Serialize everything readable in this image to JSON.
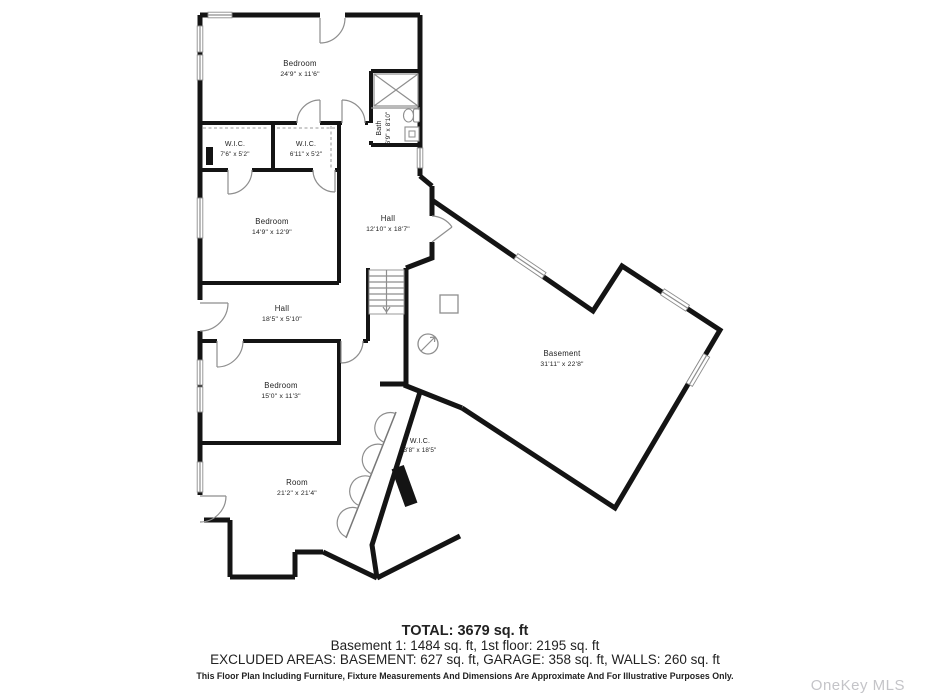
{
  "rooms": [
    {
      "name": "Bedroom",
      "dims": "24'9\" x 11'6\""
    },
    {
      "name": "W.I.C.",
      "dims": "7'6\" x 5'2\""
    },
    {
      "name": "W.I.C.",
      "dims": "6'11\" x 5'2\""
    },
    {
      "name": "Bath",
      "dims": "6'9\" x 8'10\""
    },
    {
      "name": "Bedroom",
      "dims": "14'9\" x 12'9\""
    },
    {
      "name": "Hall",
      "dims": "12'10\" x 18'7\""
    },
    {
      "name": "Hall",
      "dims": "18'5\" x 5'10\""
    },
    {
      "name": "Bedroom",
      "dims": "15'0\" x 11'3\""
    },
    {
      "name": "Room",
      "dims": "21'2\" x 21'4\""
    },
    {
      "name": "W.I.C.",
      "dims": "3'8\" x 18'5\""
    },
    {
      "name": "Basement",
      "dims": "31'11\" x 22'8\""
    }
  ],
  "footer": {
    "total": "TOTAL: 3679 sq. ft",
    "areas": "Basement 1: 1484 sq. ft, 1st floor: 2195 sq. ft",
    "excluded": "EXCLUDED AREAS: BASEMENT: 627 sq. ft, GARAGE: 358 sq. ft, WALLS: 260 sq. ft",
    "disclaimer": "This Floor Plan Including Furniture, Fixture Measurements And Dimensions Are Approximate And For Illustrative Purposes Only."
  },
  "watermark": "OneKey MLS",
  "colors": {
    "wall": "#141414",
    "thin_line": "#8e8e8e",
    "label": "#222222",
    "watermark": "#c4c4c8"
  }
}
